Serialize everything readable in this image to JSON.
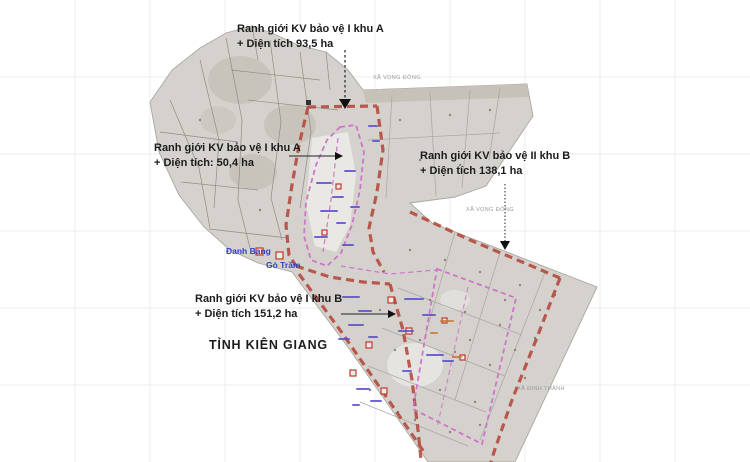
{
  "map": {
    "zone_labels": [
      {
        "line1": "Ranh giới KV bảo vệ I khu A",
        "line2": "+ Diện tích  93,5 ha"
      },
      {
        "line1": "Ranh giới KV bảo vệ I khu A",
        "line2": "+ Diện tích: 50,4 ha"
      },
      {
        "line1": "Ranh giới KV bảo vệ II khu B",
        "line2": "+ Diện tích 138,1 ha"
      },
      {
        "line1": "Ranh giới KV bảo vệ I khu B",
        "line2": "+ Diện tích 151,2  ha"
      }
    ],
    "province_label": "TỈNH KIÊN GIANG",
    "place_labels": {
      "danh_bang": "Đanh Bạng",
      "go_tram": "Gò Trầm"
    },
    "admin_labels": {
      "xa_vong_dong_north": "XÃ VỌNG ĐÔNG",
      "xa_vong_dong_east": "XÃ VỌNG ĐÔNG",
      "xa_dinh_thanh": "XÃ ĐỊNH THÀNH"
    },
    "colors": {
      "zone_boundary_red": "#b5473c",
      "inner_boundary_pink": "#cf6fc9",
      "land_gray": "#d5d2cd",
      "place_name_blue": "#2f3fbf",
      "label_black": "#1c1c1c"
    }
  }
}
